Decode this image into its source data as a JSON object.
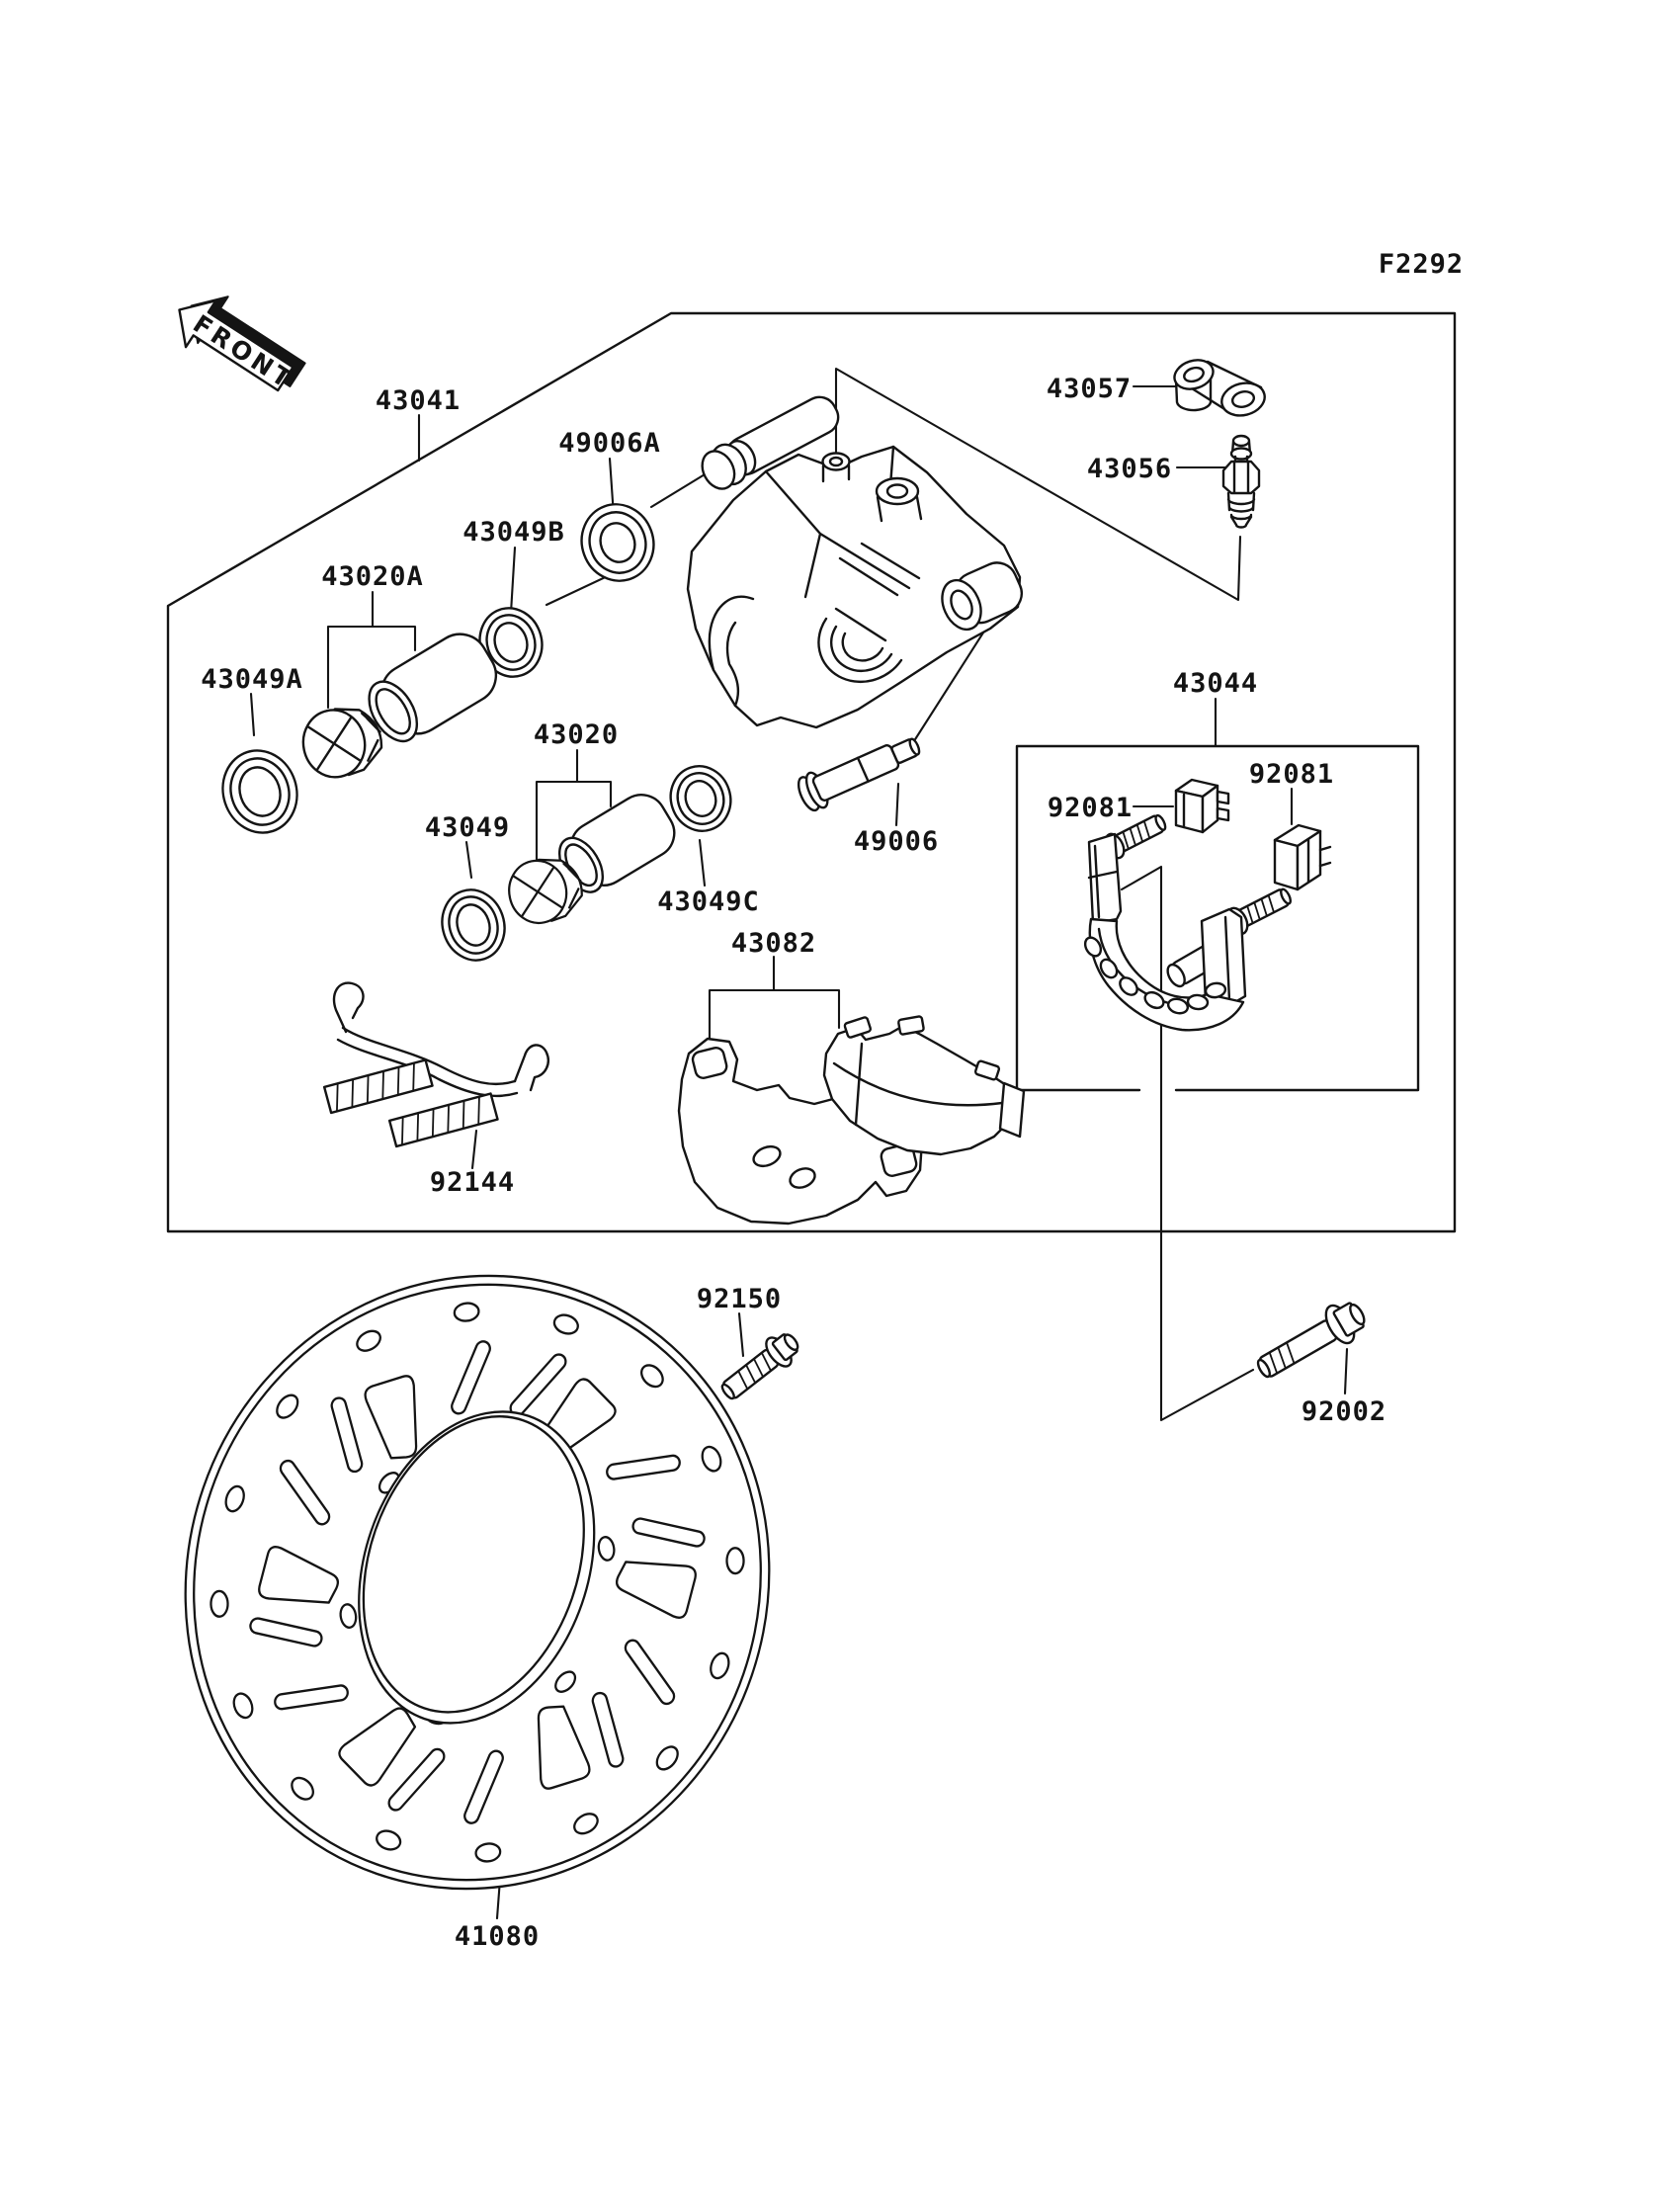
{
  "figure": {
    "code": "F2292",
    "direction_label": "FRONT"
  },
  "parts": {
    "caliper_assembly": "43041",
    "pin_boot": "49006A",
    "dust_seal_b": "43049B",
    "piston_set_a": "43020A",
    "oil_seal_a": "43049A",
    "piston_set": "43020",
    "oil_seal": "43049",
    "dust_seal_c": "43049C",
    "pad_set": "43082",
    "pad_spring": "92144",
    "joint_link": "43057",
    "bleeder_valve": "43056",
    "caliper_holder": "43044",
    "holder_clip": "92081",
    "pin_bolt": "49006",
    "disc_bolt": "92150",
    "holder_bolt": "92002",
    "brake_disc": "41080"
  },
  "colors": {
    "line": "#141414",
    "background": "#ffffff"
  }
}
